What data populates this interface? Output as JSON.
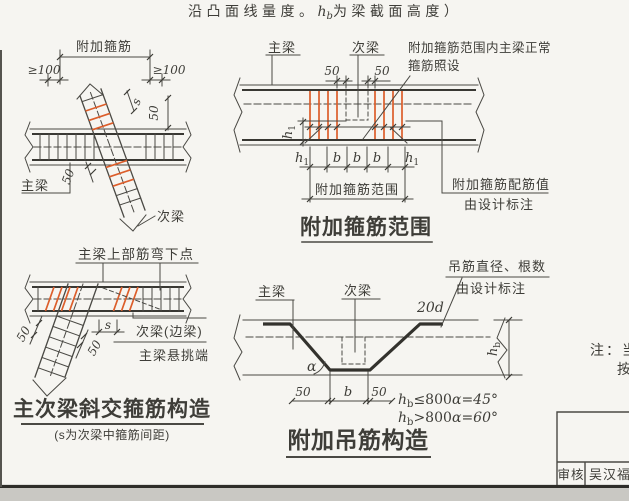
{
  "page": {
    "header_note": {
      "pre": "沿凸面线量度。",
      "var_base": "h",
      "var_sub": "b",
      "post": "为梁截面高度）"
    },
    "side_note": {
      "line1": "注：当",
      "line2": "按"
    },
    "title_block": {
      "review_label": "审核",
      "review_value": "吴汉福"
    }
  },
  "colors": {
    "paper": "#f6f5f1",
    "ink": "#45443e",
    "accent_orange": "#dc5e2b",
    "footer_strip": "#c9c8c3"
  },
  "diag_add_stirrup": {
    "title_label": "附加箍筋",
    "dim_left": "≥100",
    "dim_right": "≥100",
    "dim_s": "s",
    "dim_50_side": "50",
    "dim_50_cross": "50",
    "main_beam": "主梁",
    "secondary_beam": "次梁"
  },
  "diag_stirrup_range": {
    "main_beam": "主梁",
    "secondary_beam": "次梁",
    "note_normal_line1": "附加箍筋范围内主梁正常",
    "note_normal_line2": "箍筋照设",
    "dim_50_left": "50",
    "dim_50_right": "50",
    "h1_base": "h",
    "h1_sub": "1",
    "dim_b": "b",
    "range_label": "附加箍筋范围",
    "note_config_line1": "附加箍筋配筋值",
    "note_config_line2": "由设计标注",
    "title": "附加箍筋范围"
  },
  "diag_skew": {
    "bend_label": "主梁上部筋弯下点",
    "dim_50_a": "50",
    "dim_50_b": "50",
    "dim_s": "s",
    "edge_beam": "次梁(边梁)",
    "cantilever": "主梁悬挑端",
    "title": "主次梁斜交箍筋构造",
    "subtitle": "(s为次梁中箍筋间距)"
  },
  "diag_hanger": {
    "note_line1": "吊筋直径、根数",
    "note_line2": "由设计标注",
    "main_beam": "主梁",
    "secondary_beam": "次梁",
    "bar_extension": "20d",
    "angle": "α",
    "dim_50_left": "50",
    "dim_b": "b",
    "dim_50_right": "50",
    "hb_base": "h",
    "hb_sub": "b",
    "rule1_cond": "≤800",
    "rule1_result": "α=45°",
    "rule2_cond": ">800",
    "rule2_result": "α=60°",
    "title": "附加吊筋构造"
  }
}
